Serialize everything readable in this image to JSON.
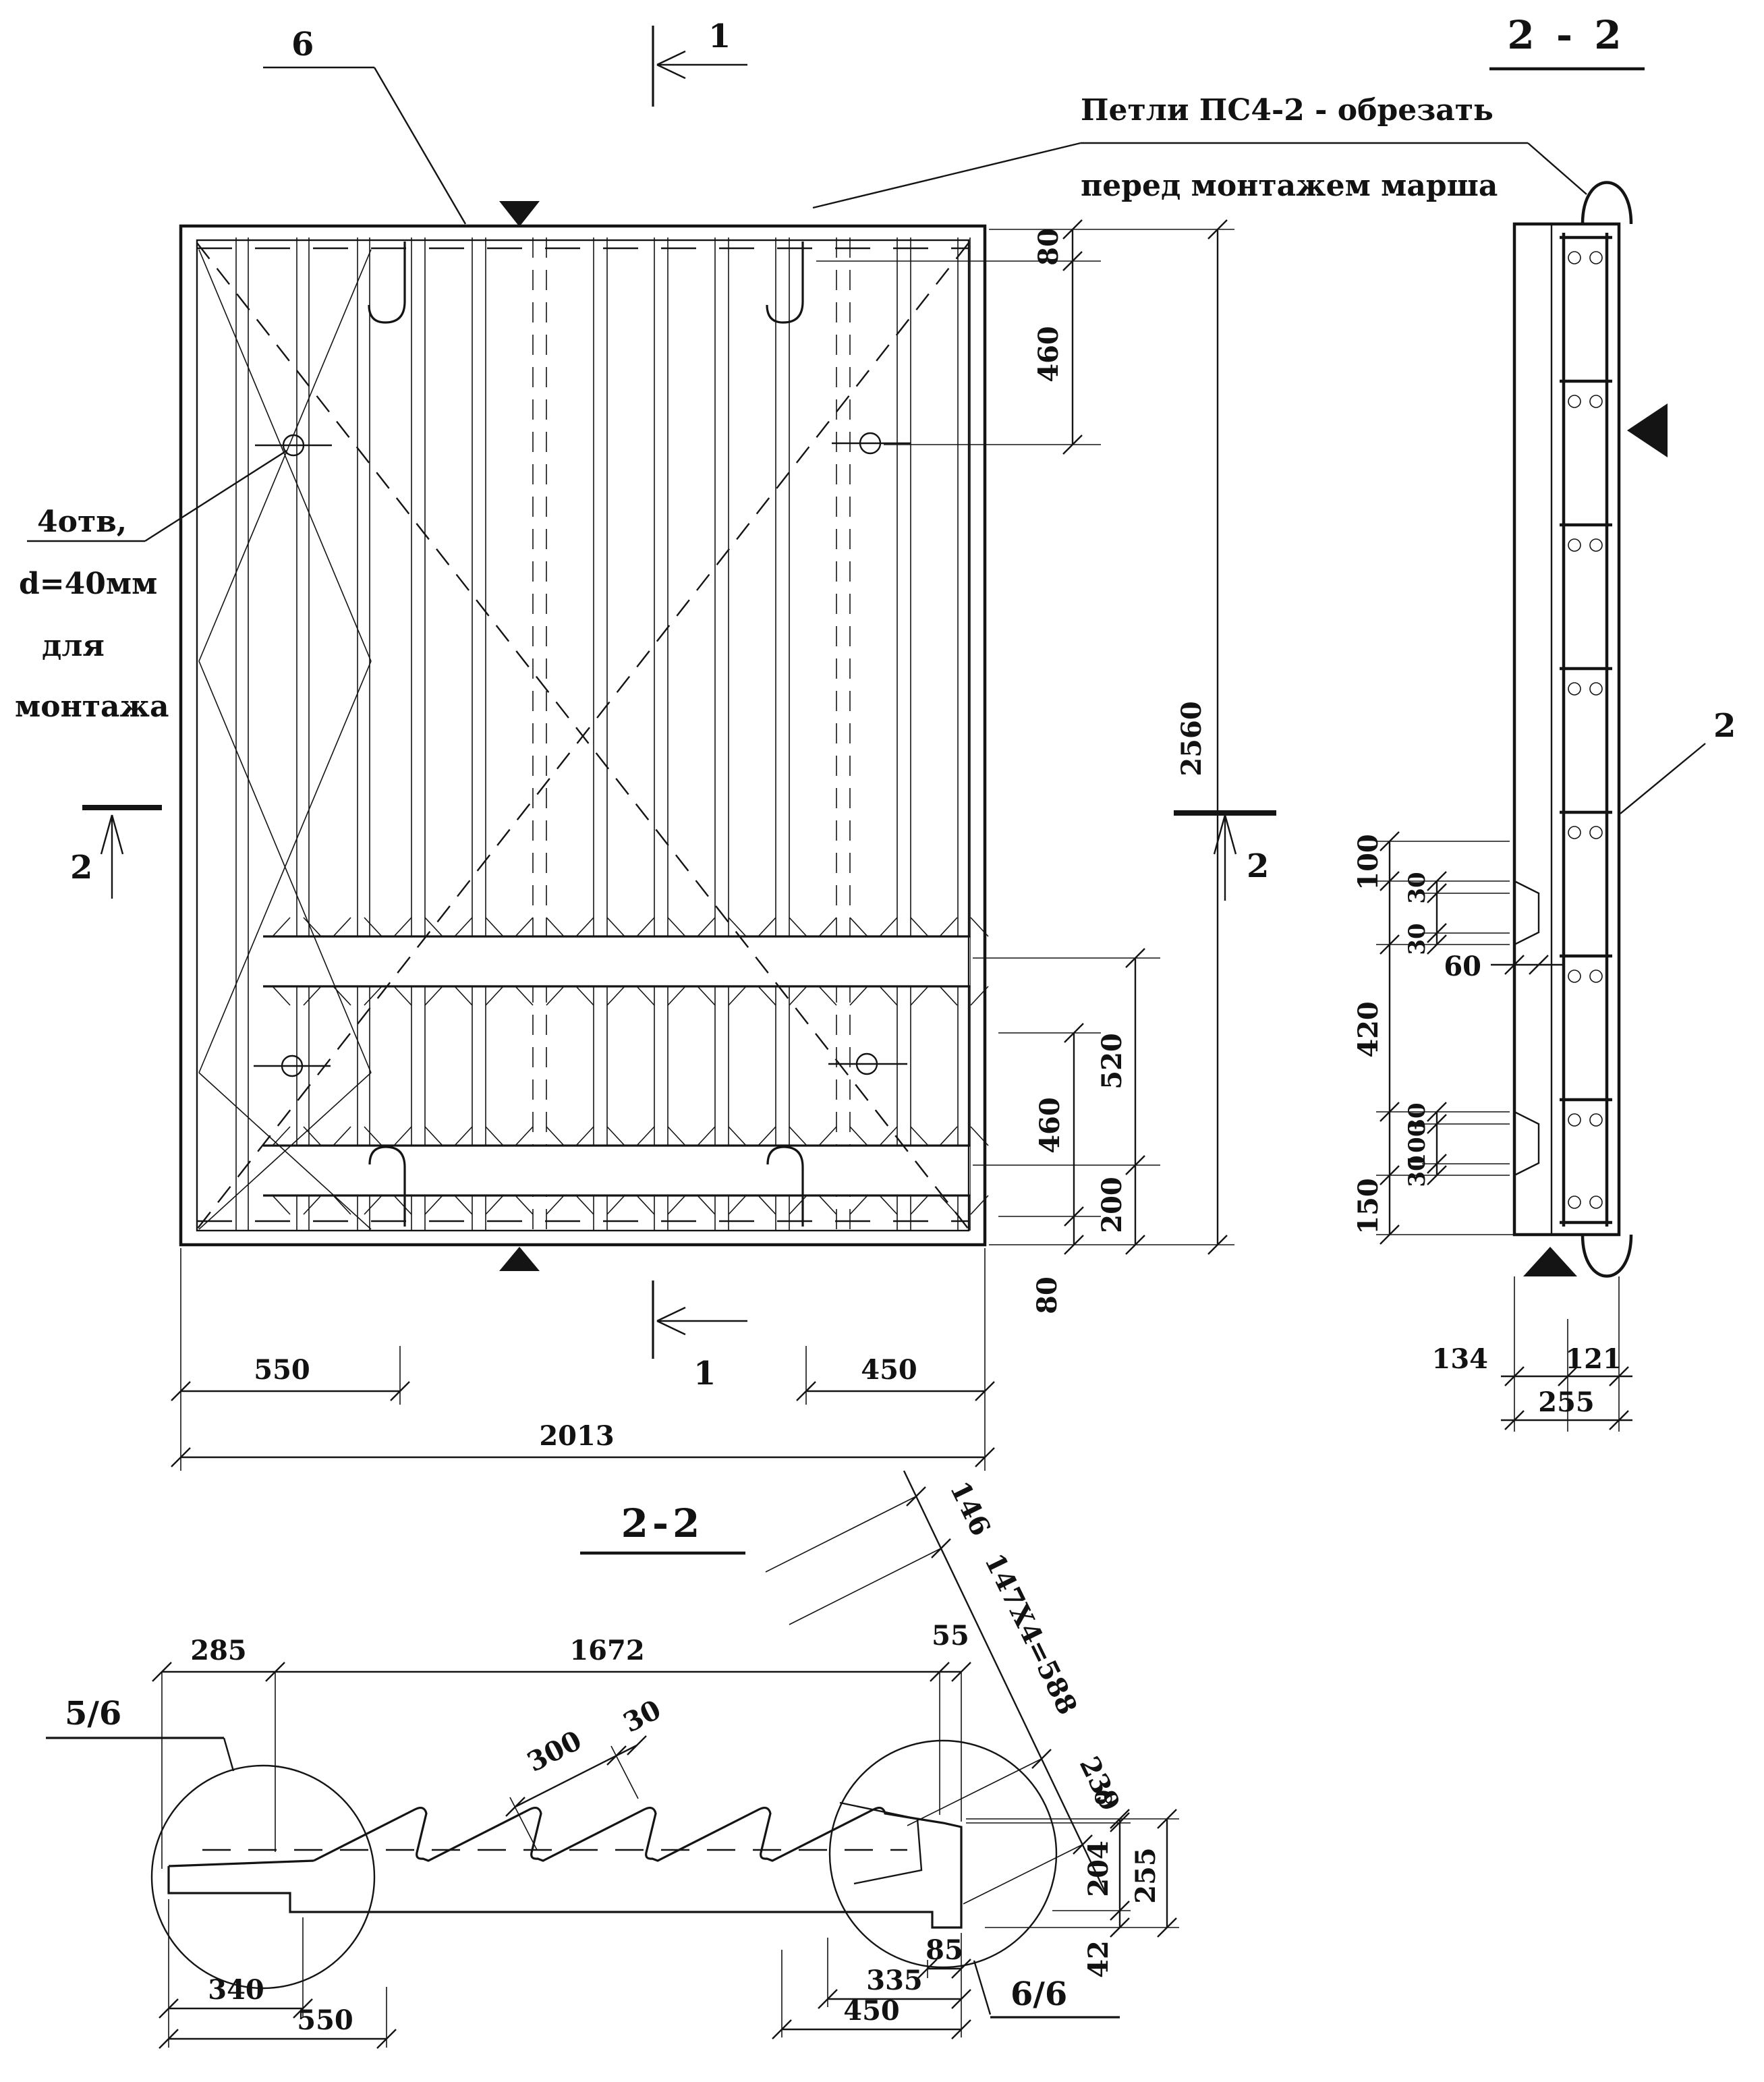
{
  "plan": {
    "callout_holes": [
      "4отв,",
      "d=40мм",
      "для",
      "монтажа"
    ],
    "callout_loops": [
      "Петли ПС4-2 - обрезать",
      "перед монтажем марша"
    ],
    "pos6": "6",
    "sec1": "1",
    "sec2": "2",
    "dims": {
      "t80": "80",
      "t460": "460",
      "h2560": "2560",
      "b520": "520",
      "b460": "460",
      "b200": "200",
      "b80": "80",
      "w550": "550",
      "w450": "450",
      "w2013": "2013"
    }
  },
  "side": {
    "title": "2 - 2",
    "pos2": "2",
    "dims": {
      "c100a": "100",
      "c30a": "30",
      "c30b": "30",
      "c420": "420",
      "c30c": "30",
      "c100b": "100",
      "c30d": "30",
      "c150": "150",
      "d60": "60",
      "b134": "134",
      "b121": "121",
      "b255": "255"
    }
  },
  "section": {
    "title": "2-2",
    "detail_left": "5/6",
    "detail_right": "6/6",
    "dims": {
      "d285": "285",
      "d1672": "1672",
      "d55": "55",
      "d146": "146",
      "d147": "147X4=588",
      "d239": "239",
      "d300": "300",
      "d30": "30",
      "d9": "9",
      "d204": "204",
      "d255": "255",
      "d42": "42",
      "d340": "340",
      "d550": "550",
      "d450": "450",
      "d335": "335",
      "d85": "85"
    }
  }
}
